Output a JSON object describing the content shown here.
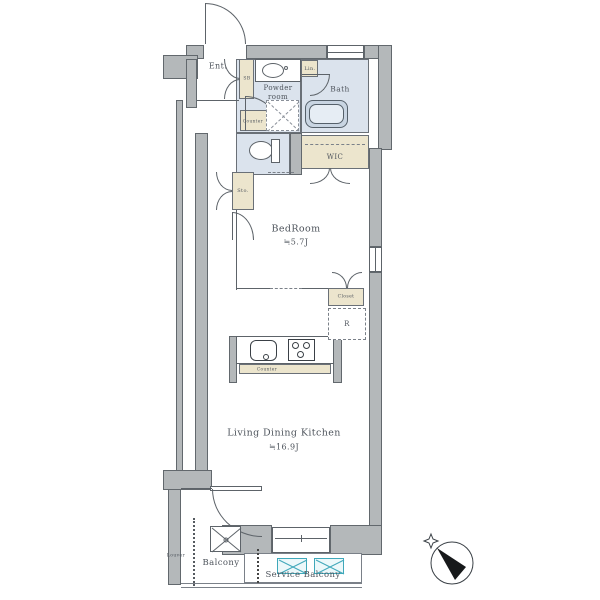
{
  "rooms": {
    "entrance": {
      "label": "Ent."
    },
    "shoe_box": {
      "label": "SB"
    },
    "powder_room": {
      "line1": "Powder",
      "line2": "room"
    },
    "linen": {
      "label": "Lin."
    },
    "bath": {
      "label": "Bath"
    },
    "wic": {
      "label": "WIC"
    },
    "storage": {
      "label": "Sto."
    },
    "bedroom": {
      "label": "BedRoom",
      "size": "≒5.7J"
    },
    "closet": {
      "label": "Closet"
    },
    "refrigerator_space": {
      "label": "R"
    },
    "powder_counter": {
      "label": "Counter"
    },
    "kitchen_counter": {
      "label": "Counter"
    },
    "ldk": {
      "label": "Living Dining Kitchen",
      "size": "≒16.9J"
    },
    "balcony": {
      "label": "Balcony"
    },
    "service_balcony": {
      "label": "Service Balcony"
    },
    "louver": {
      "label": "Louver"
    }
  },
  "colors": {
    "wall": "#b4b8ba",
    "wet_area": "#dbe3ed",
    "storage_area": "#ece5cd",
    "equipment_accent": "#3fa8ba",
    "outline": "#5d6369",
    "text": "#4e545c"
  }
}
